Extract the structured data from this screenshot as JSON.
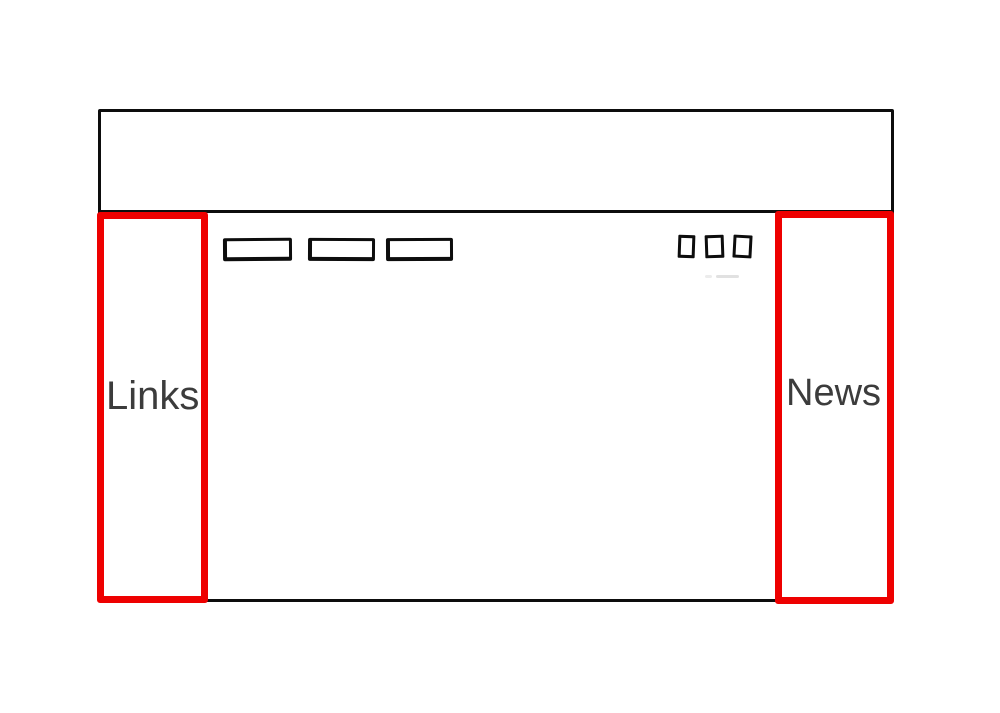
{
  "sidebars": {
    "left": {
      "label": "Links"
    },
    "right": {
      "label": "News"
    }
  },
  "wireframe": {
    "nav_button_count": 3,
    "window_control_count": 3
  },
  "colors": {
    "highlight_red": "#ee0000",
    "sketch_black": "#0d0d0d",
    "label_gray": "#3c3c3c",
    "background": "#ffffff"
  }
}
